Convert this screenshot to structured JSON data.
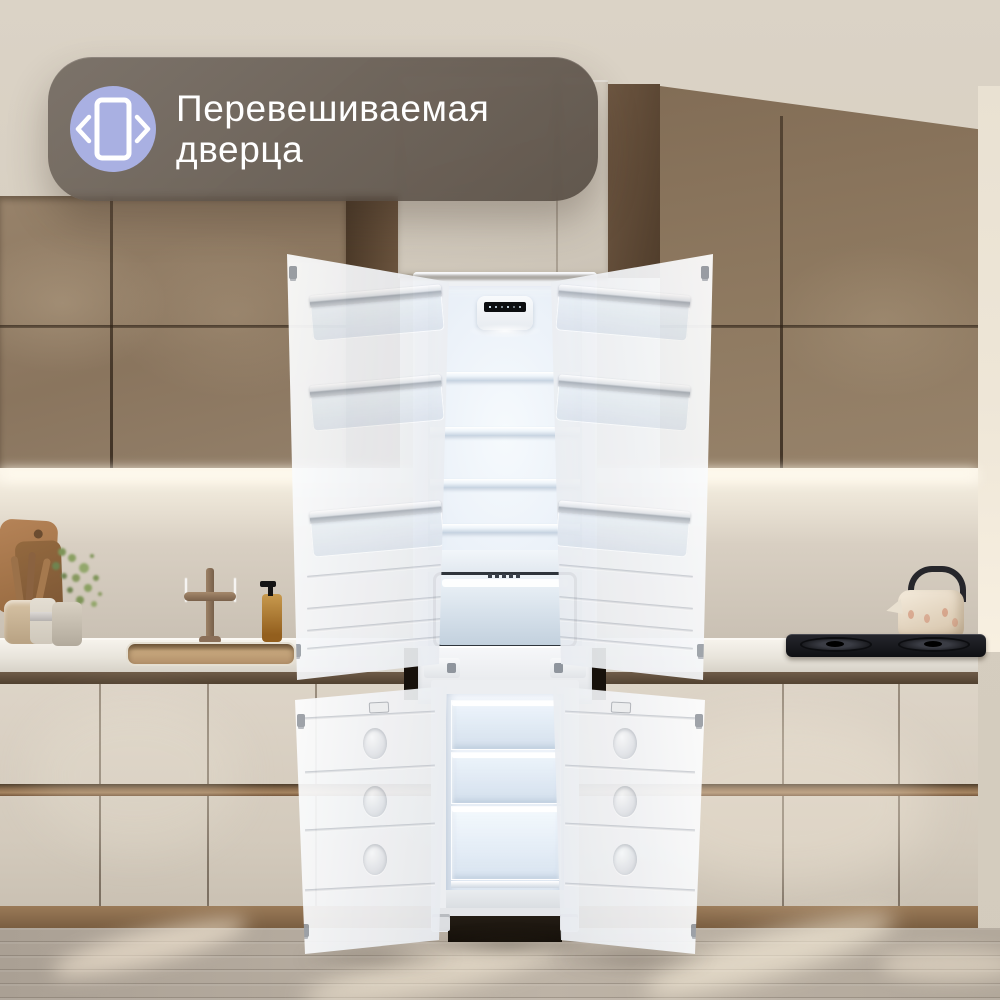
{
  "badge": {
    "line1": "Перевешиваемая",
    "line2": "дверца",
    "icon": "reversible-door-icon"
  },
  "palette": {
    "badge_bg": "rgba(86,75,65,0.82)",
    "badge_icon_circle": "#A9B0E2",
    "badge_glyph": "#FFFFFF",
    "badge_text": "#FFFFFF",
    "cabinet_bronze": "#8E7960",
    "cabinet_cream": "#D7CEC1",
    "countertop": "#ECE8E0",
    "backsplash": "#D4CBBE",
    "floor_wood": "#B5AB9F",
    "fridge_body": "#F4F5F7",
    "fridge_interior": "#E7EEF6",
    "seam_dark": "#3C2F24"
  },
  "scene": {
    "objects": [
      "upper-cabinets",
      "fridge-housing-column",
      "backsplash",
      "countertop",
      "sink",
      "faucet",
      "cutting-boards",
      "utensil-cup",
      "storage-jar",
      "plant",
      "soap-dispenser",
      "gas-cooktop",
      "kettle",
      "built-in-fridge-freezer-open",
      "lower-cabinets",
      "wood-floor"
    ]
  }
}
